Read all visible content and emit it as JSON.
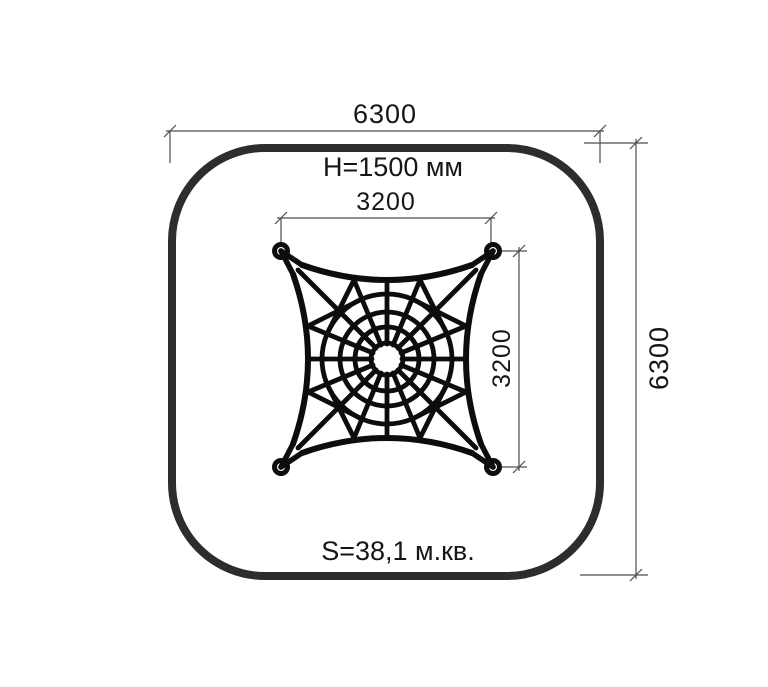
{
  "drawing": {
    "title_implicit": "spider-net playground element plan view",
    "labels": {
      "zone_width": "6300",
      "zone_height": "6300",
      "net_width": "3200",
      "net_height": "3200",
      "height_note": "H=1500 мм",
      "area_note": "S=38,1 м.кв."
    },
    "colors": {
      "safety_zone_stroke": "#2d2d2d",
      "net_stroke": "#0d0d0d",
      "dimension_stroke": "#4d4d4d",
      "text": "#161616",
      "background": "#ffffff"
    }
  }
}
